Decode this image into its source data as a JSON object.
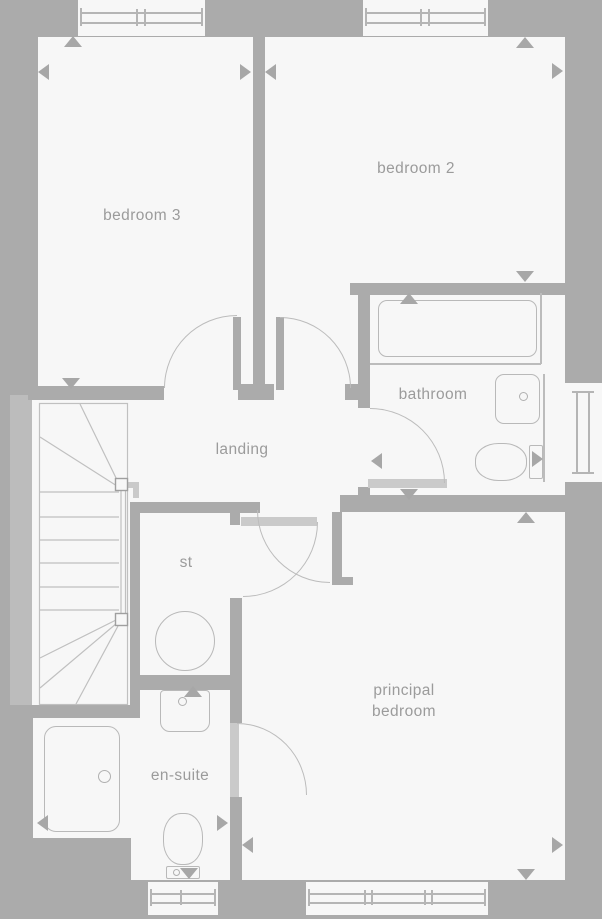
{
  "colors": {
    "background": "#ababab",
    "wall": "#ababab",
    "room_fill": "#f7f7f7",
    "fixture_line": "#b9b9b9",
    "door_leaf_open": "#cacaca",
    "label_text": "#9b9b9b",
    "marker": "#a7a7a7"
  },
  "rooms": {
    "bedroom3": {
      "label": "bedroom 3"
    },
    "bedroom2": {
      "label": "bedroom 2"
    },
    "bathroom": {
      "label": "bathroom"
    },
    "landing": {
      "label": "landing"
    },
    "storage": {
      "label": "st"
    },
    "principal_bedroom": {
      "label": "principal bedroom"
    },
    "ensuite": {
      "label": "en-suite"
    }
  },
  "icons": {
    "fixtures": [
      "bath",
      "washbasin",
      "toilet",
      "shower-tray",
      "hot-water-cylinder",
      "staircase"
    ],
    "window_symbol": "double-line-window",
    "door_symbol": "quarter-circle-swing",
    "marker_symbol": "triangle-arrow"
  }
}
